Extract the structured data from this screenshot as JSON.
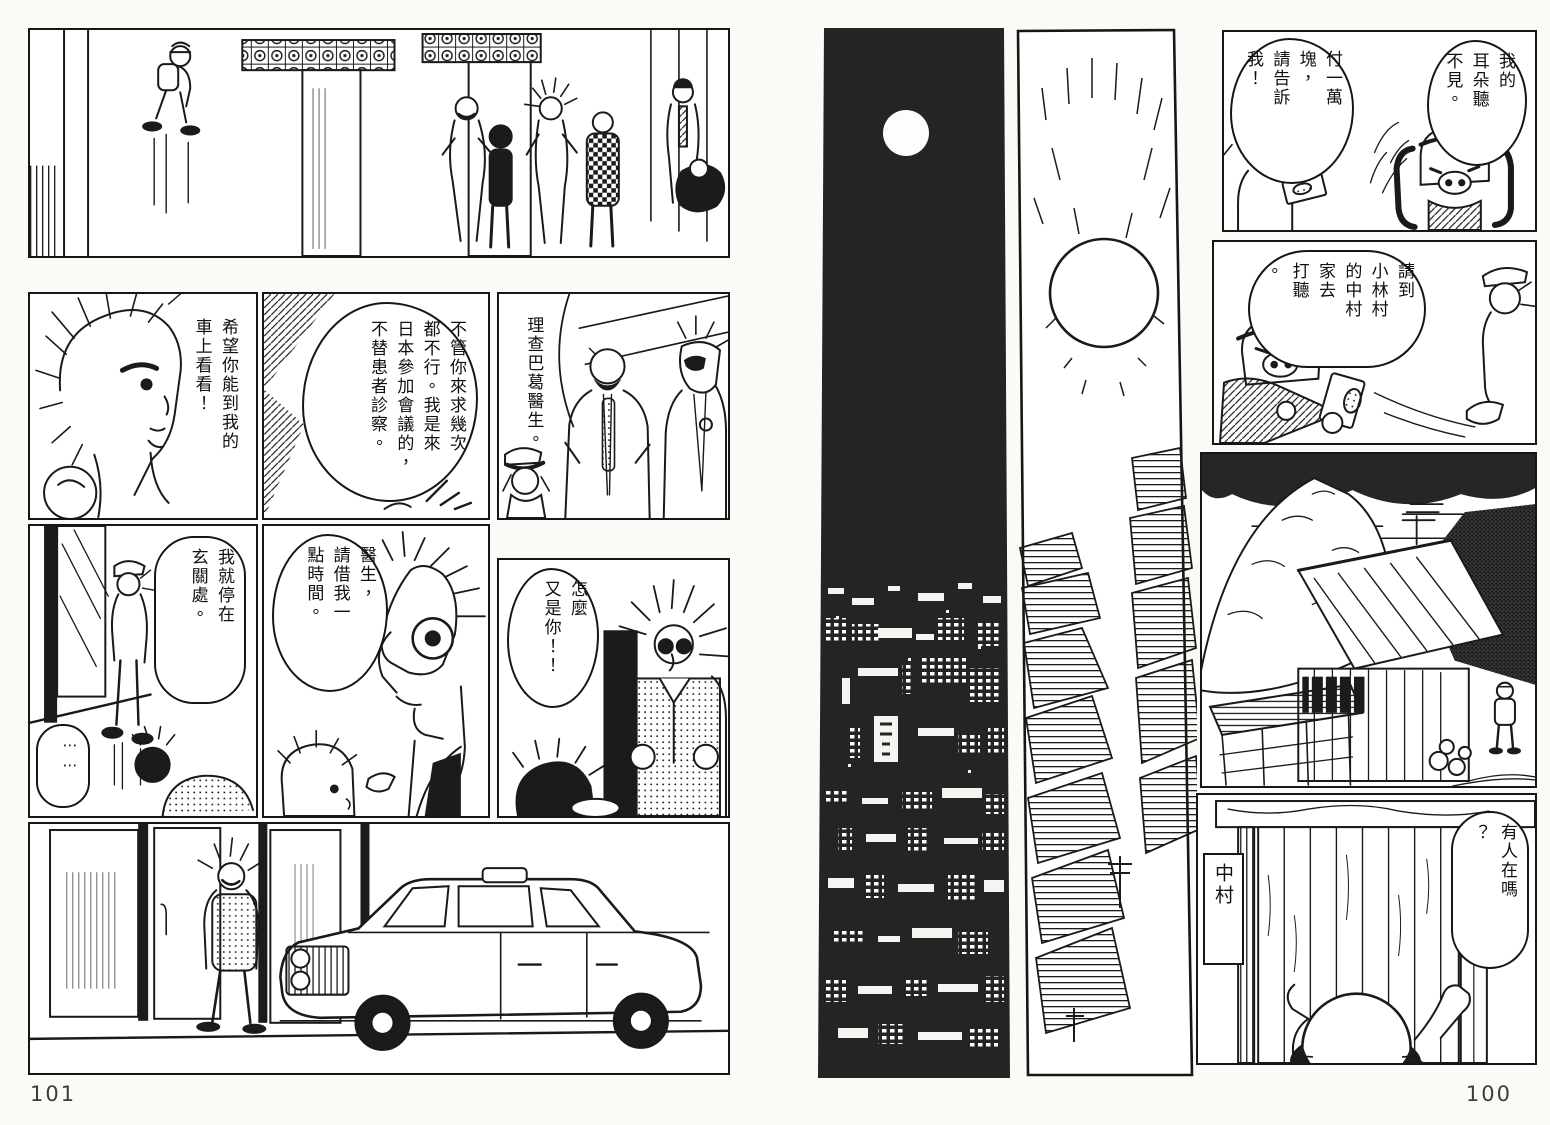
{
  "pages": {
    "left": {
      "page_number": "101",
      "bubbles": {
        "doctor_name": "理查巴葛醫生。",
        "refusal": "不管你來求幾次\n都不行。我是來\n日本參加會議的，\n不替患者診察。",
        "car_plea": "希望你能到我的\n車上看看！",
        "you_again": "怎麼\n又是你！！",
        "borrow_time": "醫生，\n請借我一\n點時間。",
        "entrance": "我就停在\n玄關處。",
        "silence": "⋯⋯"
      }
    },
    "right": {
      "page_number": "100",
      "bubbles": {
        "deaf": "我的\n耳朵聽\n不見。",
        "pay": "付一萬\n塊，\n請告訴\n我！",
        "directions": "請到\n小林村\n的中村\n家去\n打聽\n。",
        "anyone_home": "有人在嗎\n？"
      },
      "signs": {
        "nakamura": "中村"
      }
    }
  }
}
